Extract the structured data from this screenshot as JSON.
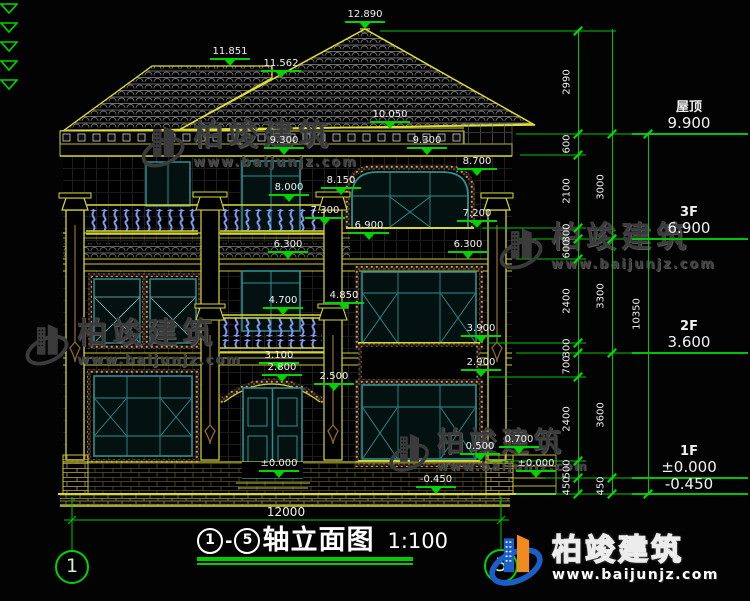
{
  "watermark": {
    "brand": "柏竣建筑",
    "url": "www.baijunjz.com"
  },
  "logo": {
    "brand": "柏竣建筑",
    "url": "www.baijunjz.com"
  },
  "title": {
    "axis_from": "1",
    "axis_to": "5",
    "dash": "-",
    "name": "轴立面图",
    "scale": "1:100"
  },
  "axis_bubbles": [
    {
      "label": "1",
      "x": 72,
      "y": 567
    },
    {
      "label": "5",
      "x": 501,
      "y": 566
    }
  ],
  "bottom_dim": {
    "label": "12000"
  },
  "annotations": [
    {
      "text": "12.890",
      "x": 365,
      "y": 29
    },
    {
      "text": "11.851",
      "x": 230,
      "y": 66
    },
    {
      "text": "11.562",
      "x": 281,
      "y": 78
    },
    {
      "text": "10.050",
      "x": 390,
      "y": 129
    },
    {
      "text": "9.300",
      "x": 284,
      "y": 155
    },
    {
      "text": "9.300",
      "x": 427,
      "y": 155
    },
    {
      "text": "8.700",
      "x": 477,
      "y": 176
    },
    {
      "text": "8.150",
      "x": 341,
      "y": 195
    },
    {
      "text": "8.000",
      "x": 289,
      "y": 202
    },
    {
      "text": "7.300",
      "x": 325,
      "y": 225
    },
    {
      "text": "7.200",
      "x": 477,
      "y": 228
    },
    {
      "text": "6.900",
      "x": 369,
      "y": 240
    },
    {
      "text": "6.300",
      "x": 288,
      "y": 259
    },
    {
      "text": "6.300",
      "x": 468,
      "y": 259
    },
    {
      "text": "4.850",
      "x": 344,
      "y": 310
    },
    {
      "text": "4.700",
      "x": 283,
      "y": 315
    },
    {
      "text": "3.900",
      "x": 481,
      "y": 343
    },
    {
      "text": "3.100",
      "x": 279,
      "y": 370
    },
    {
      "text": "2.800",
      "x": 282,
      "y": 382
    },
    {
      "text": "2.500",
      "x": 334,
      "y": 391
    },
    {
      "text": "2.900",
      "x": 481,
      "y": 377
    },
    {
      "text": "0.700",
      "x": 519,
      "y": 454
    },
    {
      "text": "0.500",
      "x": 480,
      "y": 461
    },
    {
      "text": "±0.000",
      "x": 279,
      "y": 478
    },
    {
      "text": "±0.000",
      "x": 536,
      "y": 478
    },
    {
      "text": "-0.450",
      "x": 436,
      "y": 494
    }
  ],
  "levels": [
    {
      "name": "屋顶",
      "value": "9.900",
      "y": 134
    },
    {
      "name": "3F",
      "value": "6.900",
      "y": 239
    },
    {
      "name": "2F",
      "value": "3.600",
      "y": 353
    },
    {
      "name": "1F",
      "value": "±0.000",
      "y": 478
    },
    {
      "name": "",
      "value": "-0.450",
      "y": 494
    }
  ],
  "chains": [
    {
      "x": 578,
      "y1": 29,
      "y2": 494,
      "label_x": 567,
      "ticks": [
        31,
        134,
        155,
        228,
        239,
        259,
        343,
        353,
        377,
        461,
        478,
        494
      ],
      "labels": [
        {
          "text": "2990",
          "y": 82
        },
        {
          "text": "600",
          "y": 144
        },
        {
          "text": "2100",
          "y": 191
        },
        {
          "text": "300",
          "y": 233
        },
        {
          "text": "600",
          "y": 249
        },
        {
          "text": "2400",
          "y": 301
        },
        {
          "text": "300",
          "y": 348
        },
        {
          "text": "700",
          "y": 365
        },
        {
          "text": "2400",
          "y": 419
        },
        {
          "text": "500",
          "y": 469
        },
        {
          "text": "450",
          "y": 486
        }
      ]
    },
    {
      "x": 612,
      "y1": 29,
      "y2": 494,
      "label_x": 601,
      "ticks": [
        134,
        239,
        353,
        478,
        494
      ],
      "labels": [
        {
          "text": "3000",
          "y": 187
        },
        {
          "text": "3300",
          "y": 296
        },
        {
          "text": "3600",
          "y": 415
        },
        {
          "text": "450",
          "y": 486
        }
      ]
    },
    {
      "x": 648,
      "y1": 134,
      "y2": 494,
      "label_x": 637,
      "ticks": [
        134,
        494
      ],
      "labels": [
        {
          "text": "10350",
          "y": 314
        }
      ]
    }
  ]
}
